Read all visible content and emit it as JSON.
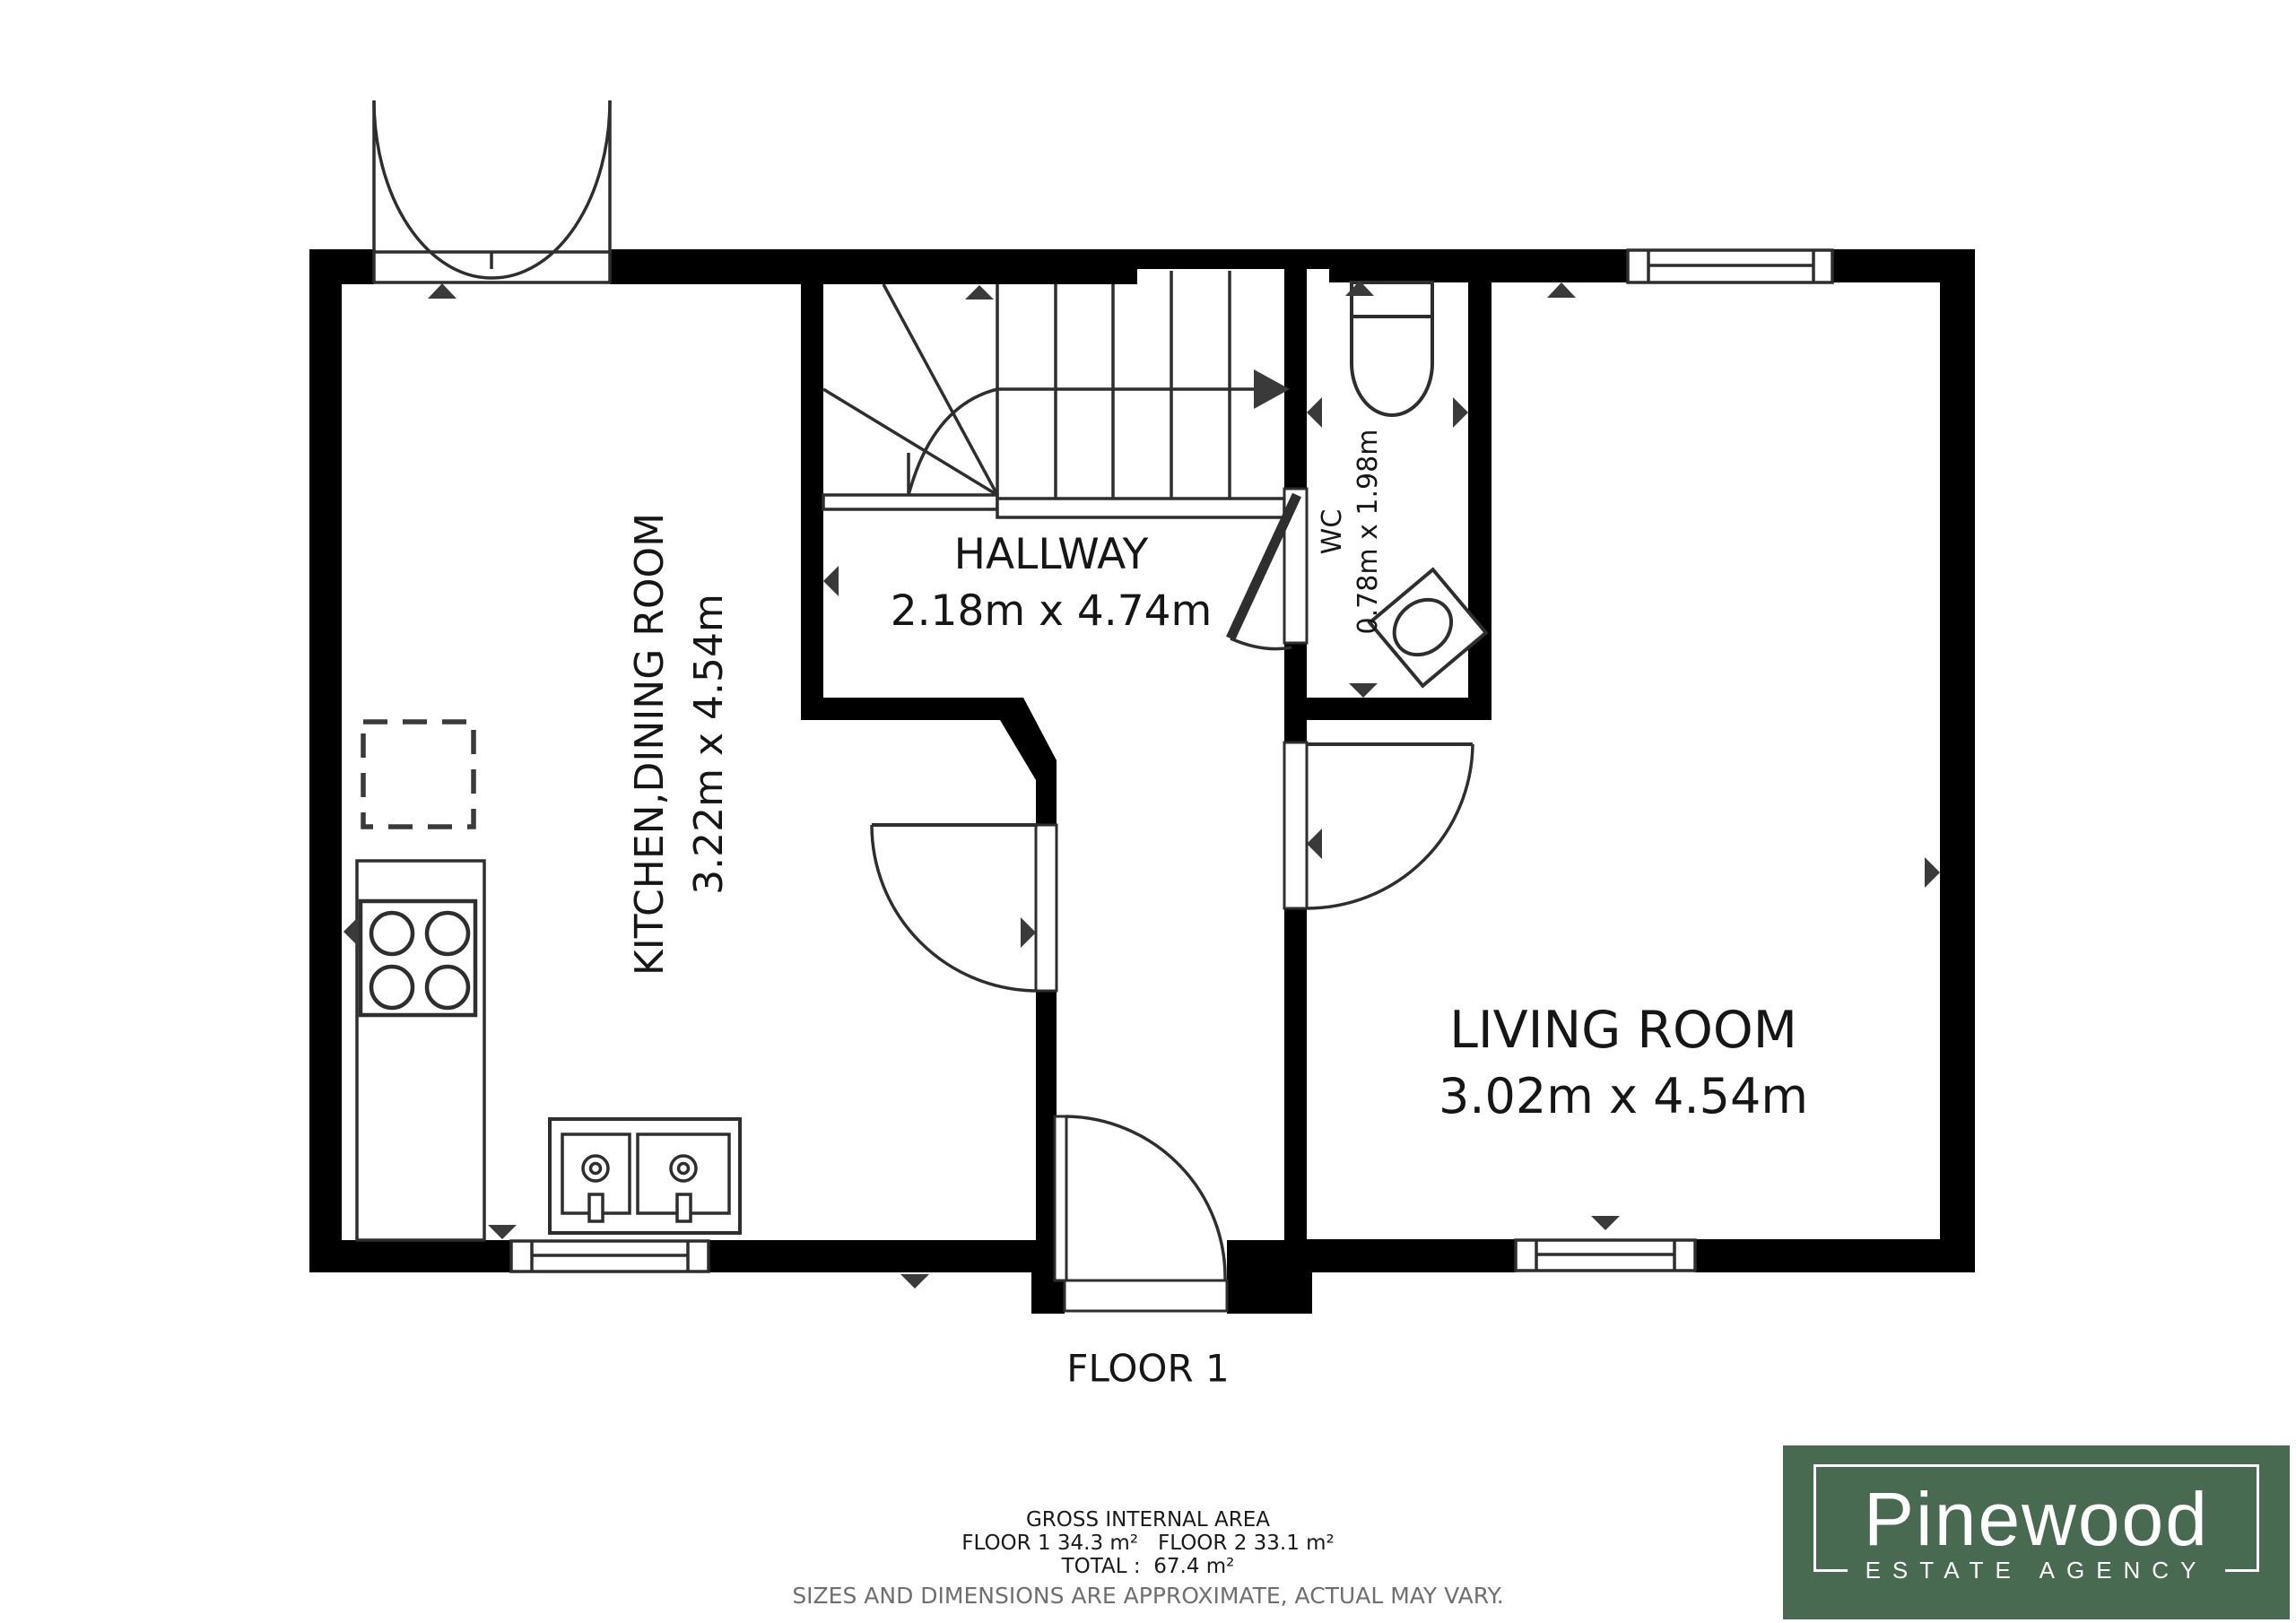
{
  "plan": {
    "floor_label": "FLOOR 1",
    "rooms": [
      {
        "id": "kitchen",
        "name": "KITCHEN,DINING ROOM",
        "dims": "3.22m x 4.54m"
      },
      {
        "id": "hallway",
        "name": "HALLWAY",
        "dims": "2.18m x 4.74m"
      },
      {
        "id": "wc",
        "name": "WC",
        "dims": "0.78m x 1.98m"
      },
      {
        "id": "living",
        "name": "LIVING ROOM",
        "dims": "3.02m x 4.54m"
      }
    ]
  },
  "footer": {
    "title": "GROSS INTERNAL AREA",
    "floors": "FLOOR 1 34.3 m²   FLOOR 2 33.1 m²",
    "total": "TOTAL :  67.4 m²",
    "disclaimer": "SIZES AND DIMENSIONS ARE APPROXIMATE, ACTUAL MAY VARY."
  },
  "logo": {
    "brand": "Pinewood",
    "tagline": "ESTATE AGENCY"
  },
  "colors": {
    "wall": "#000000",
    "line": "#2e2e2e",
    "marker": "#3a3a3a",
    "logo_green": "#486a50",
    "disclaimer_gray": "#6f6f6f"
  }
}
